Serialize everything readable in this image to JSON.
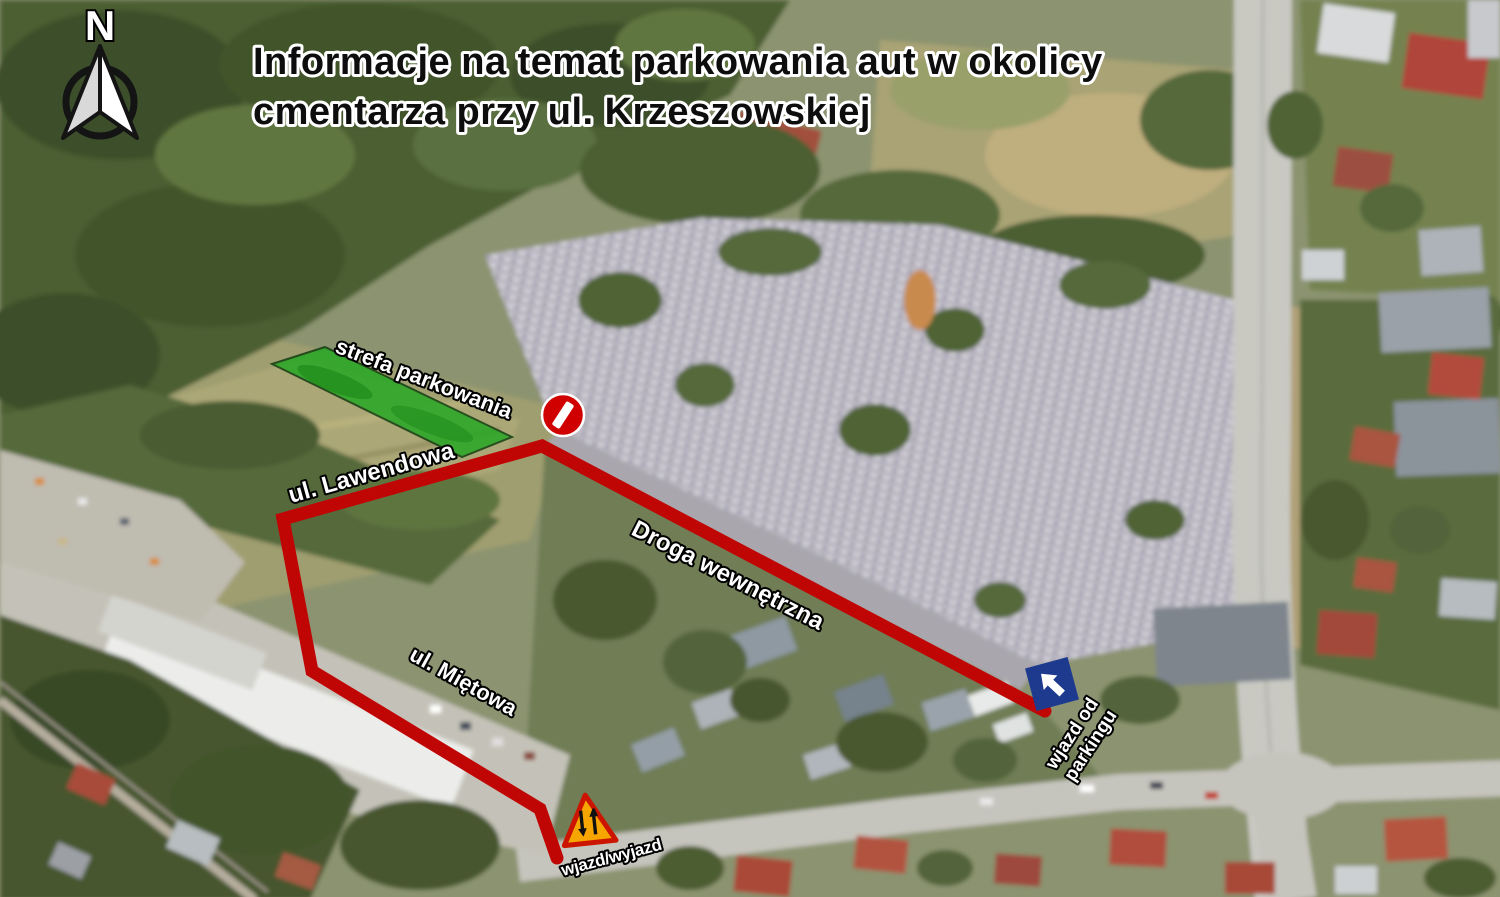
{
  "title": {
    "line1": "Informacje na temat parkowania aut w okolicy",
    "line2": "cmentarza przy ul. Krzeszowskiej"
  },
  "compass": {
    "north_label": "N"
  },
  "labels": {
    "parking_zone": "strefa parkowania",
    "street_lawendowa": "ul. Lawendowa",
    "internal_road": "Droga wewnętrzna",
    "street_mietowa": "ul. Miętowa",
    "entry_exit": "wjazd/wyjazd",
    "entry_from_parking_line1": "wjazd od",
    "entry_from_parking_line2": "parkingu"
  },
  "colors": {
    "route_red": "#c00505",
    "zone_green": "#21a821",
    "zone_outline": "#0c3b0c",
    "no_entry_red": "#d10000",
    "one_way_blue": "#1d3a8f",
    "warning_orange": "#f7a600",
    "warning_border_red": "#cc1500"
  }
}
